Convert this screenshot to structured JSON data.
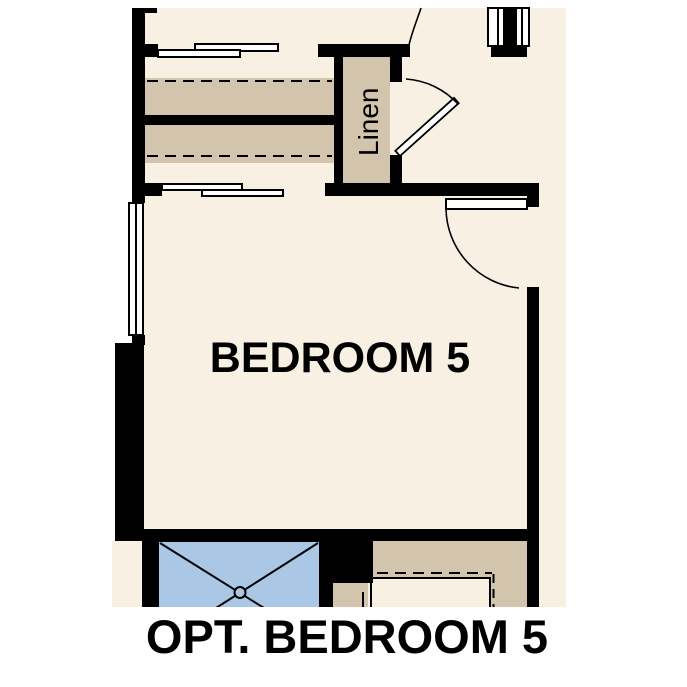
{
  "floor_plan": {
    "room_label": "BEDROOM 5",
    "closet_label": "Linen",
    "caption": "OPT. BEDROOM 5",
    "colors": {
      "background": "#ffffff",
      "floor_cream": "#f7f0e3",
      "shelf_tan": "#d3c5ad",
      "shower_blue": "#aac8e6",
      "wall_black": "#000000",
      "panel_white": "#ffffff",
      "text_black": "#000000"
    },
    "symbols": [
      "bypass-closet-doors",
      "closet-shelf-with-rod-dashed",
      "linen-closet-door-swing",
      "bedroom-entry-door-swing",
      "window",
      "shower-pan-x",
      "vanity-counter-dashed"
    ]
  }
}
